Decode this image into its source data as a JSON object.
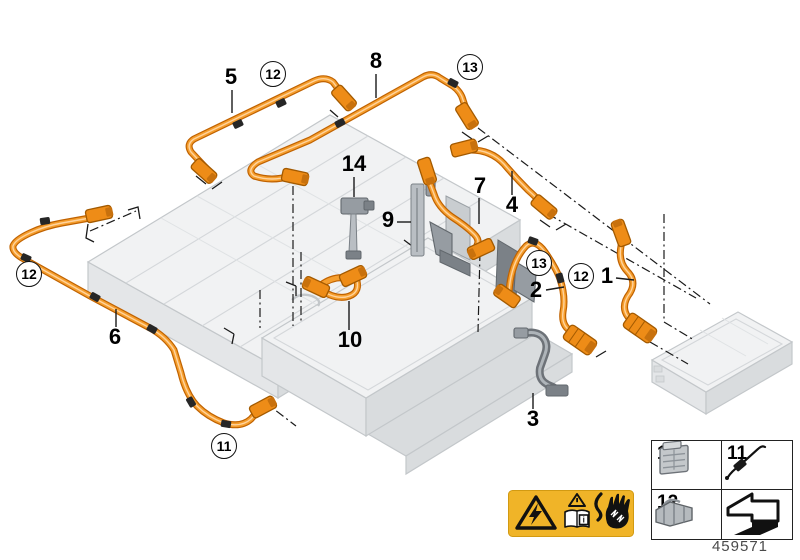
{
  "diagram": {
    "title": "High-voltage battery cable parts diagram",
    "drawing_number": "459571",
    "callouts": [
      {
        "text": "5",
        "shape": "plain",
        "x": 231,
        "y": 78,
        "leader": [
          [
            232,
            90
          ],
          [
            232,
            113
          ]
        ]
      },
      {
        "text": "12",
        "shape": "circle",
        "x": 273,
        "y": 74
      },
      {
        "text": "8",
        "shape": "plain",
        "x": 376,
        "y": 62,
        "leader": [
          [
            376,
            74
          ],
          [
            376,
            98
          ]
        ]
      },
      {
        "text": "13",
        "shape": "circle",
        "x": 470,
        "y": 67
      },
      {
        "text": "14",
        "shape": "plain",
        "x": 354,
        "y": 165,
        "leader": [
          [
            354,
            177
          ],
          [
            354,
            197
          ]
        ]
      },
      {
        "text": "9",
        "shape": "plain",
        "x": 388,
        "y": 221,
        "leader": [
          [
            397,
            222
          ],
          [
            411,
            222
          ]
        ]
      },
      {
        "text": "7",
        "shape": "plain",
        "x": 480,
        "y": 187,
        "leader": [
          [
            479,
            198
          ],
          [
            479,
            224
          ]
        ]
      },
      {
        "text": "4",
        "shape": "plain",
        "x": 512,
        "y": 206,
        "leader": [
          [
            512,
            171
          ],
          [
            512,
            195
          ]
        ]
      },
      {
        "text": "13",
        "shape": "circle",
        "x": 539,
        "y": 263
      },
      {
        "text": "12",
        "shape": "circle",
        "x": 581,
        "y": 276
      },
      {
        "text": "2",
        "shape": "plain",
        "x": 536,
        "y": 291,
        "leader": [
          [
            546,
            290
          ],
          [
            564,
            287
          ]
        ]
      },
      {
        "text": "1",
        "shape": "plain",
        "x": 607,
        "y": 277,
        "leader": [
          [
            616,
            278
          ],
          [
            634,
            280
          ]
        ]
      },
      {
        "text": "12",
        "shape": "circle",
        "x": 29,
        "y": 274
      },
      {
        "text": "6",
        "shape": "plain",
        "x": 115,
        "y": 338,
        "leader": [
          [
            116,
            309
          ],
          [
            116,
            327
          ]
        ]
      },
      {
        "text": "10",
        "shape": "plain",
        "x": 350,
        "y": 341,
        "leader": [
          [
            349,
            301
          ],
          [
            349,
            330
          ]
        ]
      },
      {
        "text": "11",
        "shape": "circle",
        "x": 224,
        "y": 446
      },
      {
        "text": "3",
        "shape": "plain",
        "x": 533,
        "y": 420,
        "leader": [
          [
            533,
            393
          ],
          [
            533,
            409
          ]
        ]
      }
    ],
    "legend": {
      "cells": [
        {
          "label": "13",
          "icon": "connector-housing-icon"
        },
        {
          "label": "11",
          "icon": "cable-tie-icon"
        },
        {
          "label": "12",
          "icon": "connector-plug-icon"
        },
        {
          "label": "",
          "icon": "direction-arrow-icon"
        }
      ]
    },
    "warning": {
      "icons": [
        "high-voltage-triangle-icon",
        "consult-manual-icon",
        "electric-shock-hand-icon"
      ],
      "book_letter": "i"
    },
    "colors": {
      "cable_orange": "#F59E2D",
      "cable_outline": "#C06200",
      "cable_highlight": "#FFD39E",
      "connector_orange": "#EE8C17",
      "connector_dark": "#C8710D",
      "pack_top": "#F1F2F3",
      "pack_side": "#E4E6E8",
      "pack_side_dark": "#D9DCDE",
      "pack_stroke": "#C3C7CA",
      "bracket_gray": "#969CA2",
      "bracket_dark": "#62686D",
      "warning_yellow": "#F0B428",
      "line_black": "#1A1A1A"
    }
  }
}
